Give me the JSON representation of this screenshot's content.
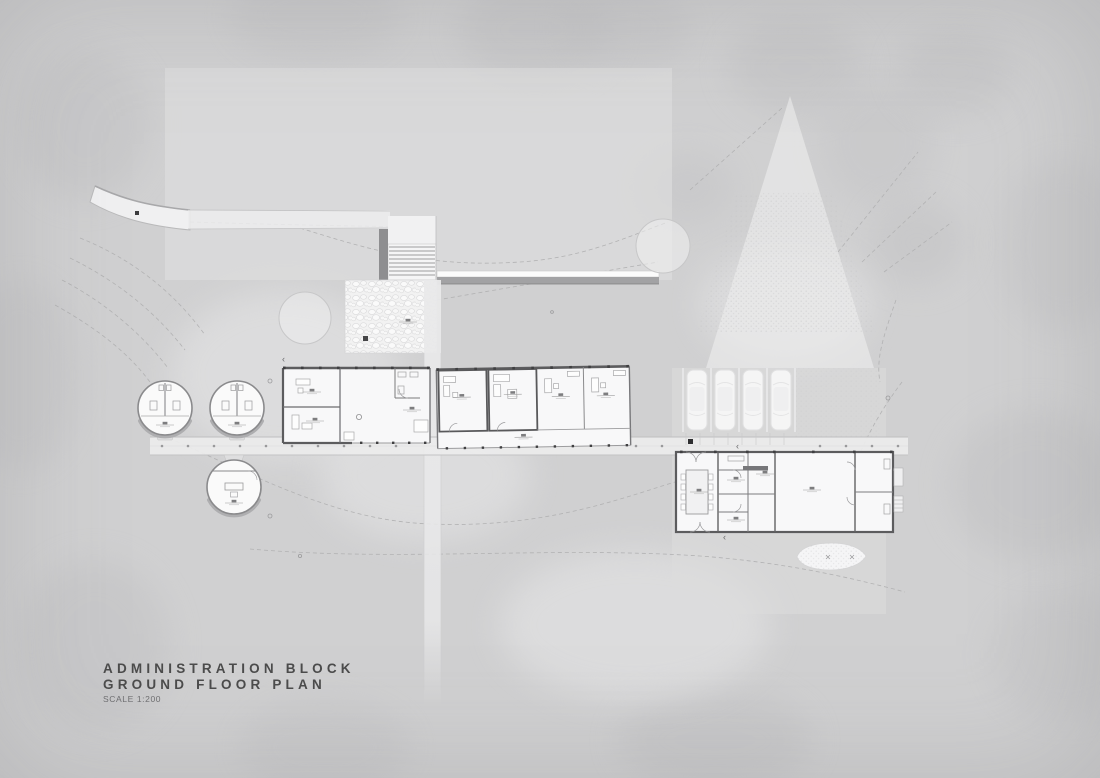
{
  "title_block": {
    "line1": "ADMINISTRATION BLOCK",
    "line2": "GROUND FLOOR PLAN",
    "scale_label": "SCALE 1:200"
  },
  "plan": {
    "drawing_type": "architectural ground floor site plan",
    "annotations": {
      "direction_marker": "‹"
    },
    "counts": {
      "parked_cars": 4,
      "circular_pods": 3,
      "office_rooms_middle_wing": 4
    },
    "features": [
      "entry stair",
      "pebble courtyard",
      "retaining wall",
      "west office wing",
      "middle office wing (4 rooms)",
      "services building with meeting room",
      "two circular toilet pods",
      "circular office pod",
      "timber boardwalk",
      "car parking (4 bays)",
      "pond",
      "contour lines"
    ],
    "colors": {
      "canvas": "#d0d0d1",
      "paper_highlight": "#e4e4e5",
      "floor": "#f8f8f8",
      "wall": "#5c5c5e",
      "line": "#9a9a9b",
      "dashed_contour": "#b3b3b4",
      "title_text": "#4b4b4b"
    }
  }
}
